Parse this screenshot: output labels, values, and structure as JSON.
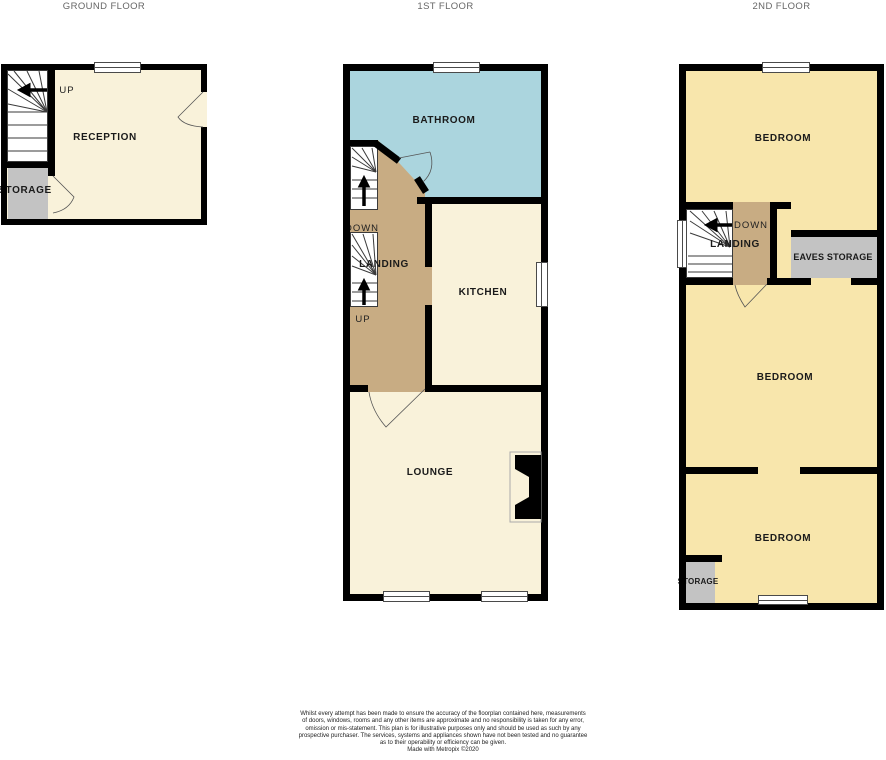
{
  "colors": {
    "wall": "#000000",
    "room_cream": "#F9F2DA",
    "room_yellow": "#F8E6AC",
    "room_blue": "#ABD5DE",
    "landing_tan": "#C8AC83",
    "storage_gray": "#C3C3C3",
    "stair_white": "#FFFFFF",
    "title_gray": "#666666",
    "label_black": "#1A1A1A"
  },
  "floors": {
    "ground": {
      "title": "GROUND FLOOR",
      "rooms": {
        "reception": "RECEPTION",
        "storage": "STORAGE"
      },
      "labels": {
        "up": "UP"
      }
    },
    "first": {
      "title": "1ST FLOOR",
      "rooms": {
        "bathroom": "BATHROOM",
        "kitchen": "KITCHEN",
        "lounge": "LOUNGE",
        "landing": "LANDING"
      },
      "labels": {
        "down": "DOWN",
        "up": "UP"
      }
    },
    "second": {
      "title": "2ND FLOOR",
      "rooms": {
        "bedroom_top": "BEDROOM",
        "bedroom_middle": "BEDROOM",
        "bedroom_bottom": "BEDROOM",
        "landing": "LANDING",
        "eaves_storage": "EAVES STORAGE",
        "storage": "STORAGE"
      },
      "labels": {
        "down": "DOWN"
      }
    }
  },
  "disclaimer": {
    "lines": [
      "Whilst every attempt has been made to ensure the accuracy of the floorplan contained here, measurements",
      "of doors, windows, rooms and any other items are approximate and no responsibility is taken for any error,",
      "omission or mis-statement. This plan is for illustrative purposes only and should be used as such by any",
      "prospective purchaser. The services, systems and appliances shown have not been tested and no guarantee",
      "as to their operability or efficiency can be given."
    ],
    "credit": "Made with Metropix ©2020"
  }
}
